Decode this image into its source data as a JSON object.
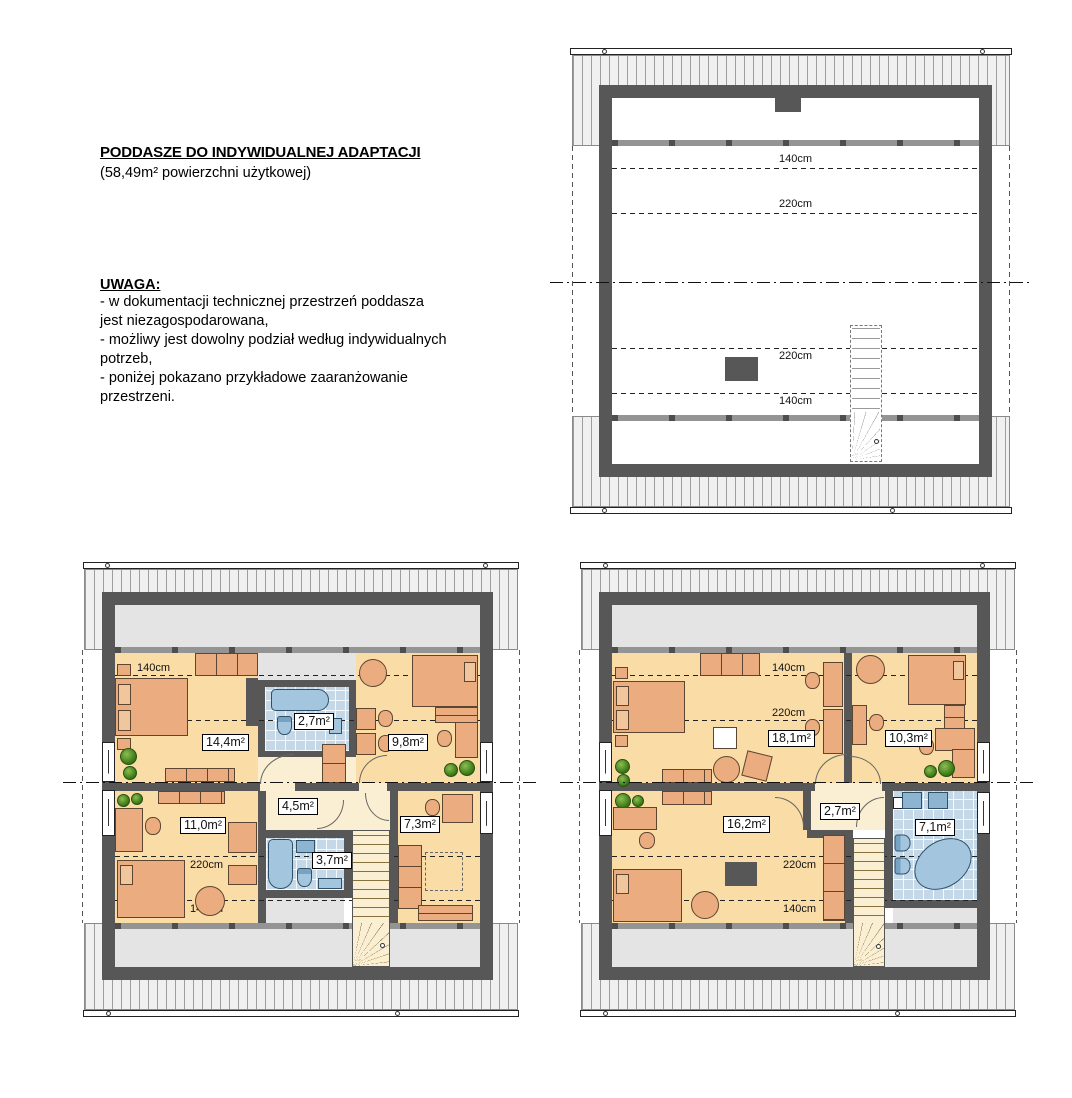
{
  "document": {
    "title": "PODDASZE DO INDYWIDUALNEJ ADAPTACJI",
    "subtitle": "(58,49m² powierzchni użytkowej)",
    "note_heading": "UWAGA:",
    "note_lines": [
      "- w dokumentacji technicznej przestrzeń poddasza",
      "jest niezagospodarowana,",
      "- możliwy jest dowolny podział według indywidualnych",
      "potrzeb,",
      "- poniżej pokazano przykładowe zaaranżowanie",
      "przestrzeni."
    ]
  },
  "plans": {
    "unfurnished": {
      "dims": {
        "top1": "140cm",
        "top2": "220cm",
        "bottom1": "220cm",
        "bottom2": "140cm"
      }
    },
    "variant_a": {
      "dims": {
        "top1": "140cm",
        "top2": "220cm",
        "bottom1": "220cm",
        "bottom2": "140cm"
      },
      "rooms": {
        "bedroom_top": "14,4m²",
        "bath_top": "2,7m²",
        "bedroom_right": "9,8m²",
        "hall": "4,5m²",
        "bedroom_left": "11,0m²",
        "bath_bottom": "3,7m²",
        "bedroom_small": "7,3m²"
      }
    },
    "variant_b": {
      "dims": {
        "top1": "140cm",
        "top2": "220cm",
        "bottom1": "220cm",
        "bottom2": "140cm"
      },
      "rooms": {
        "living": "18,1m²",
        "bedroom_right": "10,3m²",
        "bedroom_left": "16,2m²",
        "hall": "2,7m²",
        "bathroom": "7,1m²"
      }
    }
  },
  "colors": {
    "wall": "#575757",
    "floor_room": "#FADCA6",
    "floor_hall": "#FAEFD2",
    "bath_tile": "#C4D8E8",
    "bath_fixture": "#A3C6DE",
    "furniture": "#EBAC7F",
    "furniture_light": "#F2C69C",
    "low_zone": "#E4E4E4",
    "roof_band": "#F0F0F0",
    "plant_green": "#3C7A18"
  }
}
